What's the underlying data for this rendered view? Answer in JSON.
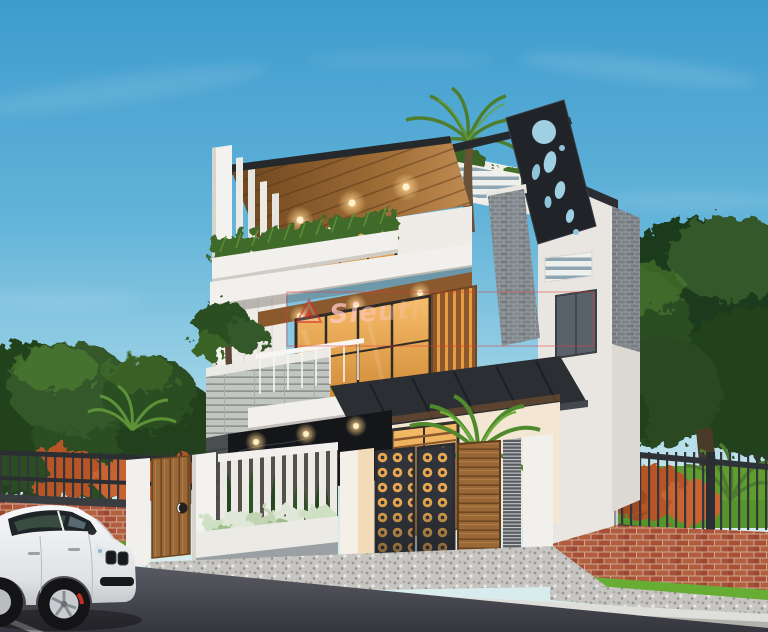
{
  "watermark": {
    "text": "Sieuth",
    "frame_color": "#e03a3a",
    "logo": "triangle-logo"
  },
  "palette": {
    "sky_top": "#3d9bcd",
    "sky_horizon": "#d8ecee",
    "wall_white": "#f2f0ec",
    "soffit_wood": "#c08b52",
    "door_wood": "#9a6836",
    "warm_light": "#f3a94e",
    "roof_dark": "#26292c",
    "decor_panel_black": "#202327",
    "foliage_dark": "#24421d",
    "foliage_light": "#5d9338",
    "brick_red": "#a84f35",
    "brick_gray": "#9aa0a5",
    "lawn_green": "#67ac33",
    "gravel_gray": "#c6c5c1",
    "road_asphalt": "#4a4a52",
    "car_white": "#f2f2f4"
  },
  "scene": {
    "objects": [
      "sky",
      "clouds",
      "trees-left",
      "trees-right",
      "left-metal-fence",
      "left-brick-wall",
      "right-metal-fence",
      "right-brick-wall",
      "right-lawn",
      "house",
      "fin-wall",
      "roof-eave",
      "soffit-downlights",
      "decor-panel",
      "roof-beam",
      "terrace-railing",
      "roof-palm-tree",
      "third-floor-window",
      "balcony-planter",
      "gray-brick-column",
      "second-floor-window",
      "wood-slat-screen",
      "balcony-tree",
      "stone-parapet",
      "balcony-railing",
      "entrance-canopy",
      "marble-wall",
      "ground-glass-doors",
      "entrance-door",
      "yard-palm",
      "front-fence",
      "pedestrian-door",
      "white-slat-fence",
      "cypress-trees",
      "shrub-planter",
      "gate-lattice-panels",
      "gate-wood-panel",
      "gate-louver-panel",
      "fence-pillars",
      "driveway-gravel",
      "sidewalk",
      "curb",
      "road",
      "road-marking",
      "car",
      "watermark"
    ]
  }
}
